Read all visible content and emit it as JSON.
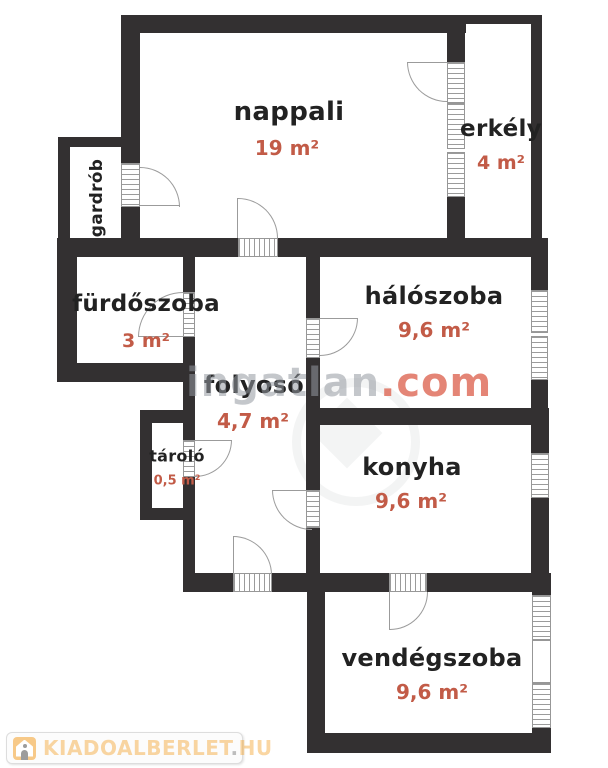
{
  "floorplan": {
    "type": "apartment-floor-plan",
    "rooms": [
      {
        "name": "nappali",
        "area": "19 m²"
      },
      {
        "name": "erkély",
        "area": "4 m²"
      },
      {
        "name": "gardrób",
        "area": ""
      },
      {
        "name": "fürdőszoba",
        "area": "3 m²"
      },
      {
        "name": "hálószoba",
        "area": "9,6 m²"
      },
      {
        "name": "folyosó",
        "area": "4,7 m²"
      },
      {
        "name": "tároló",
        "area": "0,5 m²"
      },
      {
        "name": "konyha",
        "area": "9,6 m²"
      },
      {
        "name": "vendégszoba",
        "area": "9,6 m²"
      }
    ],
    "colors": {
      "wall": "#333031",
      "room_label": "#222222",
      "area_label": "#c25b47",
      "symbol_line": "#9b9b9b"
    }
  },
  "watermark": {
    "gray_part": "ingatlan",
    "accent_part": ".com",
    "gray_color": "#9499a0",
    "accent_color": "#dd6350"
  },
  "logo": {
    "site": "KIADOALBERLET",
    "separator": ".",
    "tld": "HU",
    "icon": "house-icon",
    "text_color": "#f4a430"
  }
}
